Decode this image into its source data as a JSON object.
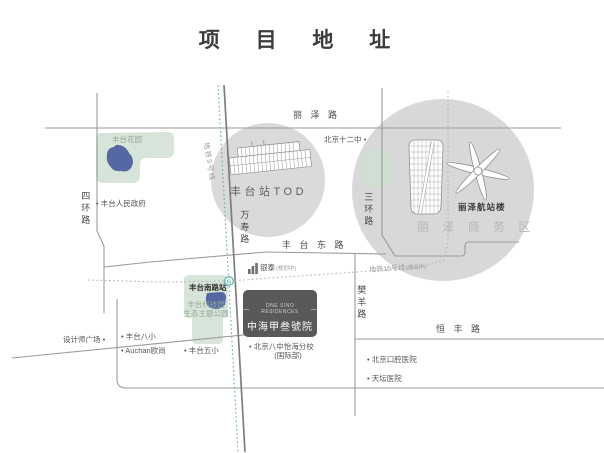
{
  "title": "项 目 地 址",
  "map": {
    "roads": {
      "lize": "丽 泽 路",
      "sihuan": "四环路",
      "sanhuan": "三环路",
      "wanshou": "万寿路",
      "fengtai_east": "丰 台 东 路",
      "fanyang": "樊羊路",
      "hengfeng": "恒 丰 路"
    },
    "transit": {
      "line9": "地铁9号线",
      "line16": "地铁16号线",
      "line16_note": "(建设中)",
      "station": "丰台南路站"
    },
    "areas": {
      "tod": "丰台站TOD",
      "lize_terminal": "丽泽航站楼",
      "lize_cbd": "丽 泽 商 务 区",
      "fengtai_garden": "丰台花园",
      "science_park_1": "丰台科技园",
      "science_park_2": "生态主题公园"
    },
    "pois": {
      "bj12": "北京十二中 •",
      "gov": "• 丰台人民政府",
      "yintai": "银泰",
      "yintai_note": "(规划中)",
      "designer_plaza": "设计师广场 •",
      "ft8": "• 丰台八小",
      "auchan": "• Auchan欧尚",
      "ft5": "• 丰台五小",
      "school8": "• 北京八中怡海分校",
      "school8_sub": "(国际部)",
      "stomatology": "• 北京口腔医院",
      "tiantan": "• 天坛医院"
    },
    "project": {
      "en": "ONE SINO RESIDENCES",
      "cn": "中海甲叁號院"
    },
    "colors": {
      "circle_fill": "#d9d9d9",
      "park_fill": "#d6e4d9",
      "pond_fill": "#5668a3",
      "metro_teal": "#45a8a1",
      "road_gray": "#9b9b9b",
      "badge_bg": "#595959",
      "green_text": "#93ab97"
    }
  }
}
